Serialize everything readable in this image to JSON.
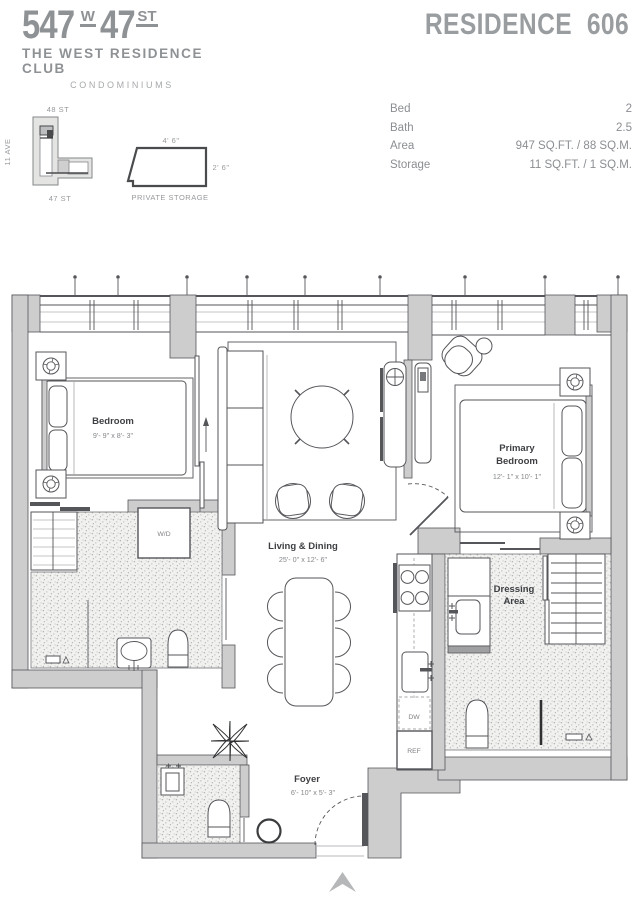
{
  "brand": {
    "address_number": "547",
    "address_w": "W",
    "address_47": "47",
    "address_st": "ST",
    "subtitle": "THE WEST RESIDENCE CLUB",
    "tagline": "CONDOMINIUMS"
  },
  "residence": {
    "label": "RESIDENCE",
    "number": "606"
  },
  "details": {
    "rows": [
      {
        "label": "Bed",
        "value": "2"
      },
      {
        "label": "Bath",
        "value": "2.5"
      },
      {
        "label": "Area",
        "value": "947 SQ.FT. / 88 SQ.M."
      },
      {
        "label": "Storage",
        "value": "11 SQ.FT. / 1 SQ.M."
      }
    ]
  },
  "key_map": {
    "street_top": "48 ST",
    "street_bottom": "47 ST",
    "avenue": "11 AVE"
  },
  "storage_diagram": {
    "width_label": "4' 6\"",
    "depth_label": "2' 6\"",
    "caption": "PRIVATE STORAGE"
  },
  "floor_plan": {
    "rooms": [
      {
        "name": "Bedroom",
        "dims": "9'- 9\" x 8'- 3\""
      },
      {
        "name": "Living & Dining",
        "dims": "25'- 0\" x 12'- 6\""
      },
      {
        "name": "Primary",
        "name2": "Bedroom",
        "dims": "12'- 1\" x 10'- 1\""
      },
      {
        "name": "Dressing",
        "name2": "Area"
      },
      {
        "name": "Foyer",
        "dims": "6'- 10\" x 5'- 3\""
      }
    ],
    "appliances": {
      "wd": "W/D",
      "dw": "DW",
      "ref": "REF"
    }
  },
  "colors": {
    "wall_gray": "#cdcdce",
    "line_dark": "#55565a",
    "brand_gray": "#8f9295",
    "label_dark": "#3d3f42"
  }
}
